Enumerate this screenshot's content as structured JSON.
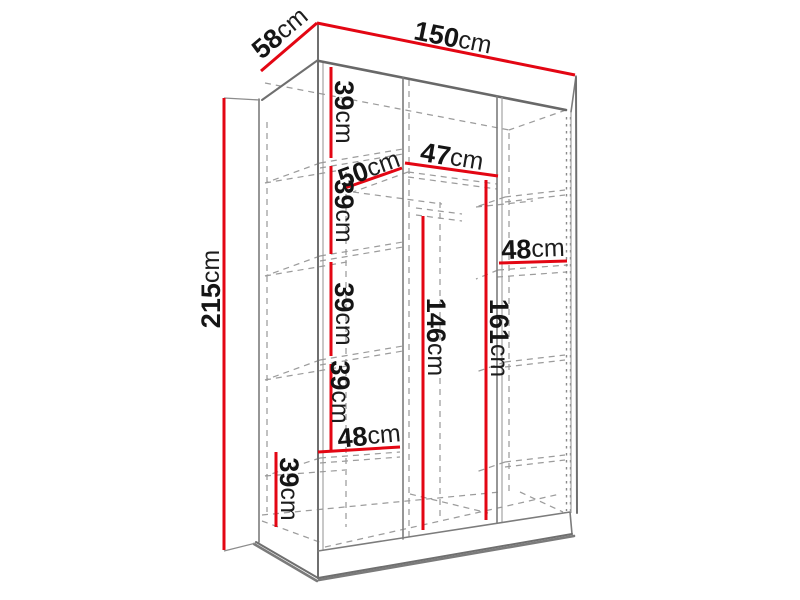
{
  "diagram_type": "furniture-dimension-diagram",
  "subject": "three-section wardrobe with shelves and hanging rail, isometric line drawing",
  "units": "cm",
  "colors": {
    "dimension_red": "#e30613",
    "outline_gray": "#7c7c7c",
    "hidden_dash_gray": "#9c9c9c",
    "shadow_gray": "#4f4f4f",
    "label_black": "#151515",
    "background": "#ffffff"
  },
  "dims": {
    "width": {
      "v": "150",
      "u": "cm"
    },
    "depth": {
      "v": "58",
      "u": "cm"
    },
    "height": {
      "v": "215",
      "u": "cm"
    },
    "left_shelf_1": {
      "v": "39",
      "u": "cm"
    },
    "left_shelf_2": {
      "v": "39",
      "u": "cm"
    },
    "left_shelf_3": {
      "v": "39",
      "u": "cm"
    },
    "left_shelf_4": {
      "v": "39",
      "u": "cm"
    },
    "bottom_shelf": {
      "v": "39",
      "u": "cm"
    },
    "shelf_depth": {
      "v": "50",
      "u": "cm"
    },
    "middle_width": {
      "v": "47",
      "u": "cm"
    },
    "right_width": {
      "v": "48",
      "u": "cm"
    },
    "left_width": {
      "v": "48",
      "u": "cm"
    },
    "rail_height": {
      "v": "146",
      "u": "cm"
    },
    "middle_height": {
      "v": "161",
      "u": "cm"
    }
  }
}
